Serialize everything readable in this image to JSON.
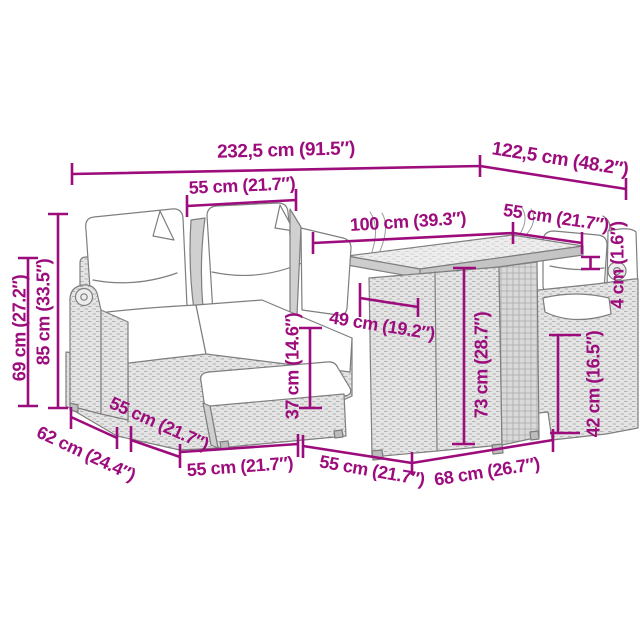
{
  "figure": {
    "subject": "Line drawing of a poly rattan garden lounge set (corner sofa with back and seat cushions, footstool with cushion, storage table with glass-look top, right seat with armrest) annotated with product dimensions",
    "background_color": "#ffffff",
    "dimension_color": "#9D0C7C",
    "drawing_line_color": "#7e7e7e"
  },
  "dims": {
    "total_width": "232,5 cm (91.5″)",
    "total_depth": "122,5 cm (48.2″)",
    "seat_width": "55 cm (21.7″)",
    "table_length": "100 cm (39.3″)",
    "table_top_depth": "55 cm (21.7″)",
    "table_top_thickness": "4 cm (1.6″)",
    "inner_seat_depth": "49 cm (19.2″)",
    "footstool_height": "37 cm (14.6″)",
    "table_height": "73 cm (28.7″)",
    "seat_height": "42 cm (16.5″)",
    "armrest_height": "69 cm (27.2″)",
    "backrest_height": "85 cm (33.5″)",
    "sofa_depth": "62 cm (24.4″)",
    "seat_side_depth": "55 cm (21.7″)",
    "footstool_width": "55 cm (21.7″)",
    "table_side_depth": "55 cm (21.7″)",
    "table_front_width": "68 cm (26.7″)"
  }
}
